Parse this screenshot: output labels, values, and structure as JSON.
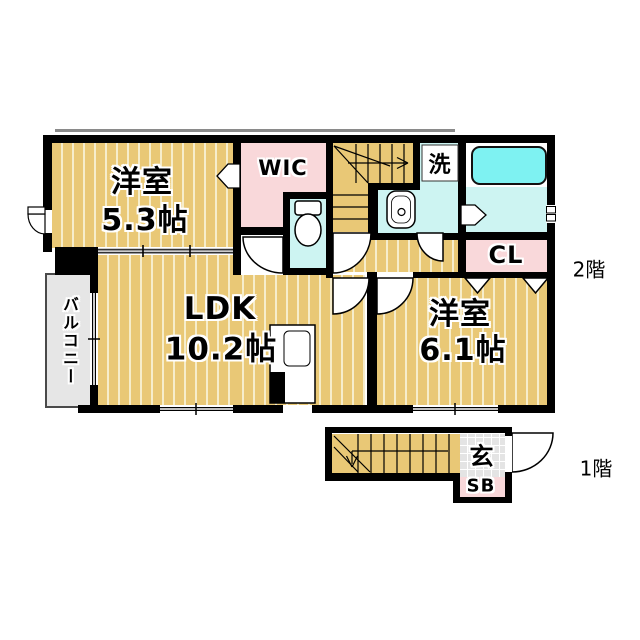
{
  "floor_plan": {
    "second_floor": {
      "floor_label": "2階",
      "bedroom_53": {
        "name": "洋室",
        "size": "5.3帖"
      },
      "wic_label": "WIC",
      "laundry_label": "洗",
      "closet_label": "CL",
      "ldk": {
        "name": "LDK",
        "size": "10.2帖"
      },
      "bedroom_61": {
        "name": "洋室",
        "size": "6.1帖"
      },
      "balcony_label": "バルコニー"
    },
    "first_floor": {
      "floor_label": "1階",
      "entrance_label": "玄",
      "shoe_box_label": "SB"
    },
    "colors": {
      "floor_tan": "#E9C876",
      "floor_stripe": "#F6EDCB",
      "closet_pink": "#F9D8DA",
      "wet_area_cyan": "#CDF4F2",
      "bathtub_cyan": "#7EF2F2",
      "balcony_gray": "#E6E6E6",
      "wall": "#000000"
    }
  }
}
